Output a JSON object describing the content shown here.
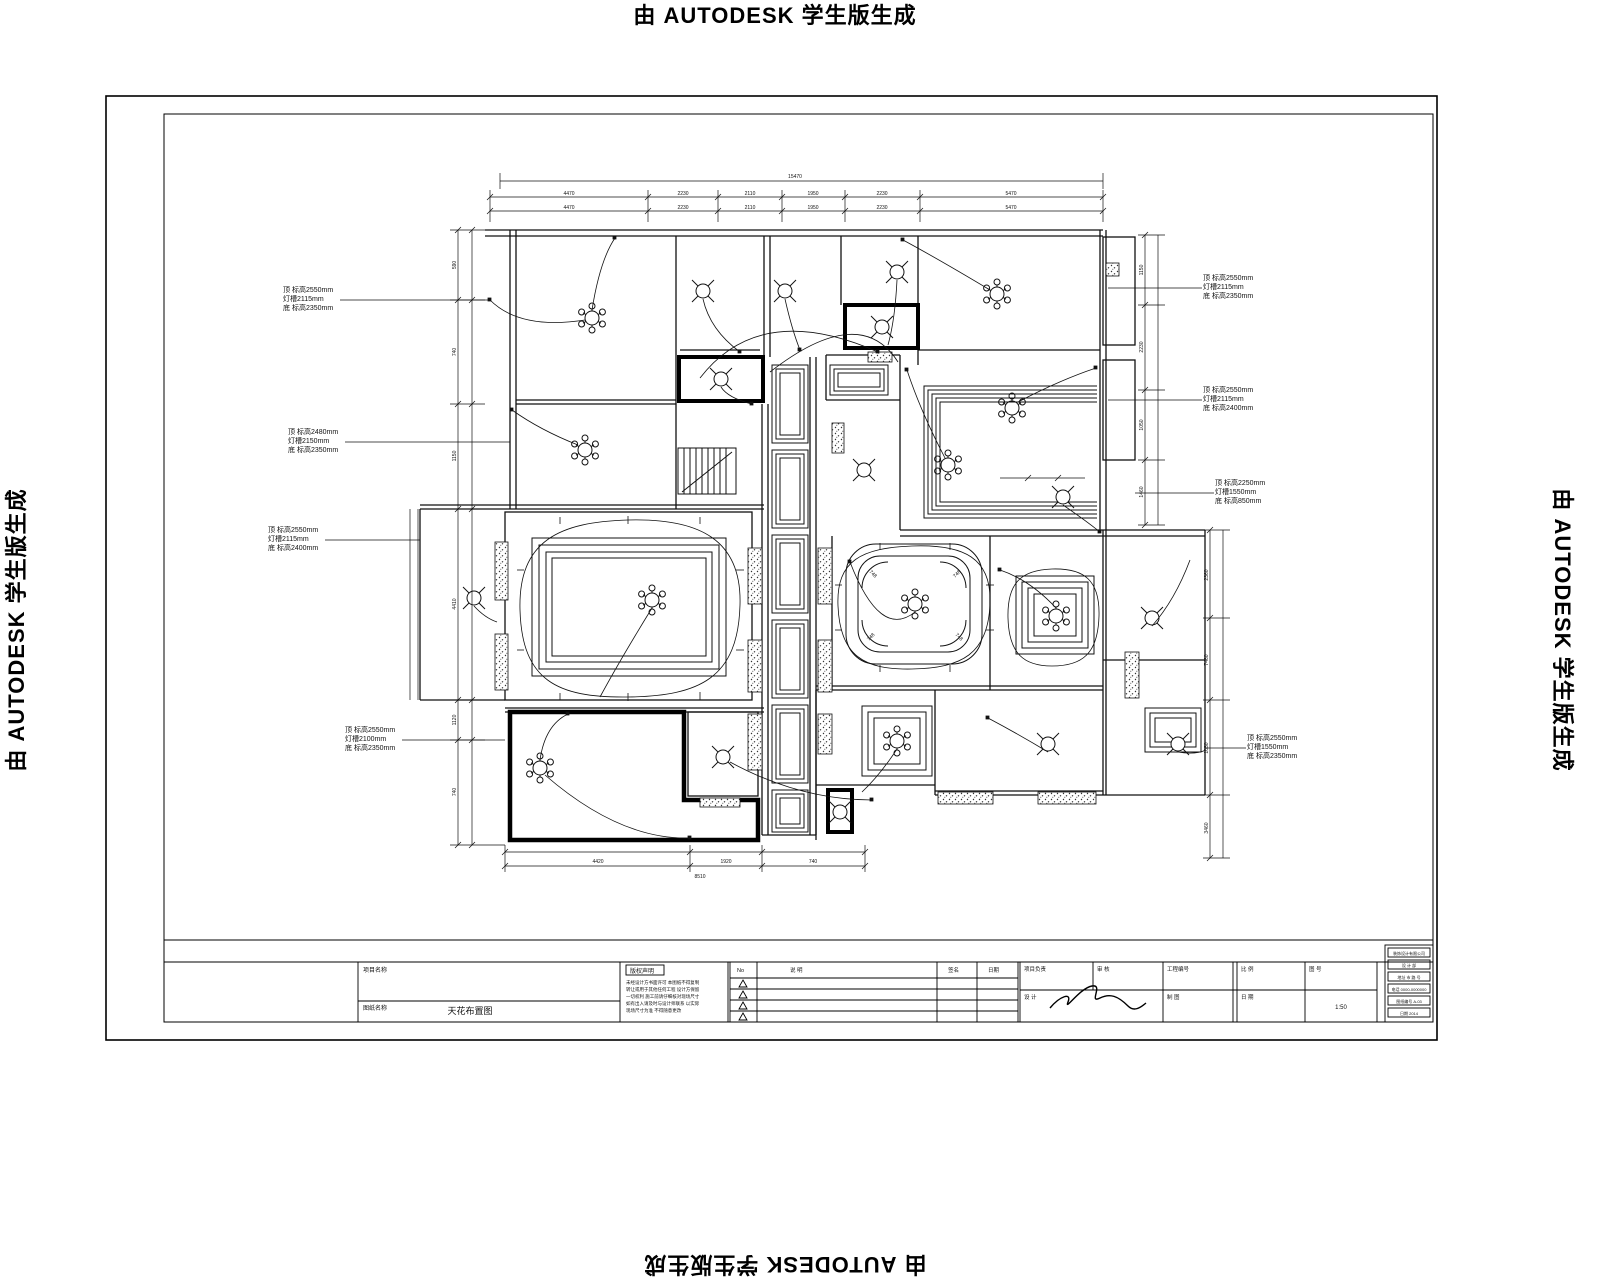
{
  "watermark": {
    "text": "由 AUTODESK 学生版生成"
  },
  "drawing": {
    "annotations": {
      "l1": {
        "lines": [
          "顶 标高2550mm",
          "灯槽2115mm",
          "底 标高2350mm"
        ]
      },
      "l2": {
        "lines": [
          "顶 标高2480mm",
          "灯槽2150mm",
          "底 标高2350mm"
        ]
      },
      "l3": {
        "lines": [
          "顶 标高2550mm",
          "灯槽2115mm",
          "底 标高2400mm"
        ]
      },
      "l4": {
        "lines": [
          "顶 标高2550mm",
          "灯槽2100mm",
          "底 标高2350mm"
        ]
      },
      "r1": {
        "lines": [
          "顶 标高2550mm",
          "灯槽2115mm",
          "底 标高2350mm"
        ]
      },
      "r2": {
        "lines": [
          "顶 标高2550mm",
          "灯槽2115mm",
          "底 标高2400mm"
        ]
      },
      "r3": {
        "lines": [
          "顶 标高2250mm",
          "灯槽1550mm",
          "底 标高850mm"
        ]
      },
      "r4": {
        "lines": [
          "顶 标高2550mm",
          "灯槽1550mm",
          "底 标高2350mm"
        ]
      }
    },
    "dims": {
      "overall_top": "15470",
      "top": [
        "4470",
        "2230",
        "2110",
        "1950",
        "2230",
        "5470"
      ],
      "left": [
        "590",
        "740",
        "1150",
        "4410",
        "1120",
        "740"
      ],
      "right_upper": [
        "1150",
        "2230",
        "1050",
        "1460"
      ],
      "right_lower": [
        "2360",
        "7460",
        "1050",
        "3460"
      ],
      "bottom": [
        "4420",
        "1920",
        "740"
      ],
      "overall_bottom": "8510",
      "inside": "748"
    }
  },
  "title_block": {
    "project_label": "项目名称",
    "drawing_label": "图纸名称",
    "drawing_name": "天花布置图",
    "copyright_label": "版权声明",
    "copyright_lines": [
      "未经设计方书面许可 本图纸不得复制",
      "转让或用于其他任何工程 设计方保留",
      "一切权利 施工前请仔细核对现场尺寸",
      "如有出入请及时与设计师联系 以实际",
      "现场尺寸为准 不得随意更改"
    ],
    "revision_headers": [
      "No",
      "说 明",
      "签名",
      "日期"
    ],
    "fields_row1": [
      "项目负责",
      "审 核",
      "工程编号",
      "比 例",
      "图 号"
    ],
    "fields_row2": [
      "设 计",
      "制 图",
      "日 期"
    ],
    "scale_value": "1:50",
    "company_lines": [
      "装饰设计有限公司",
      "设 计 部",
      "地址 市 路 号",
      "电话 0000-0000000",
      "图纸编号 A-03",
      "日期 2014"
    ]
  }
}
